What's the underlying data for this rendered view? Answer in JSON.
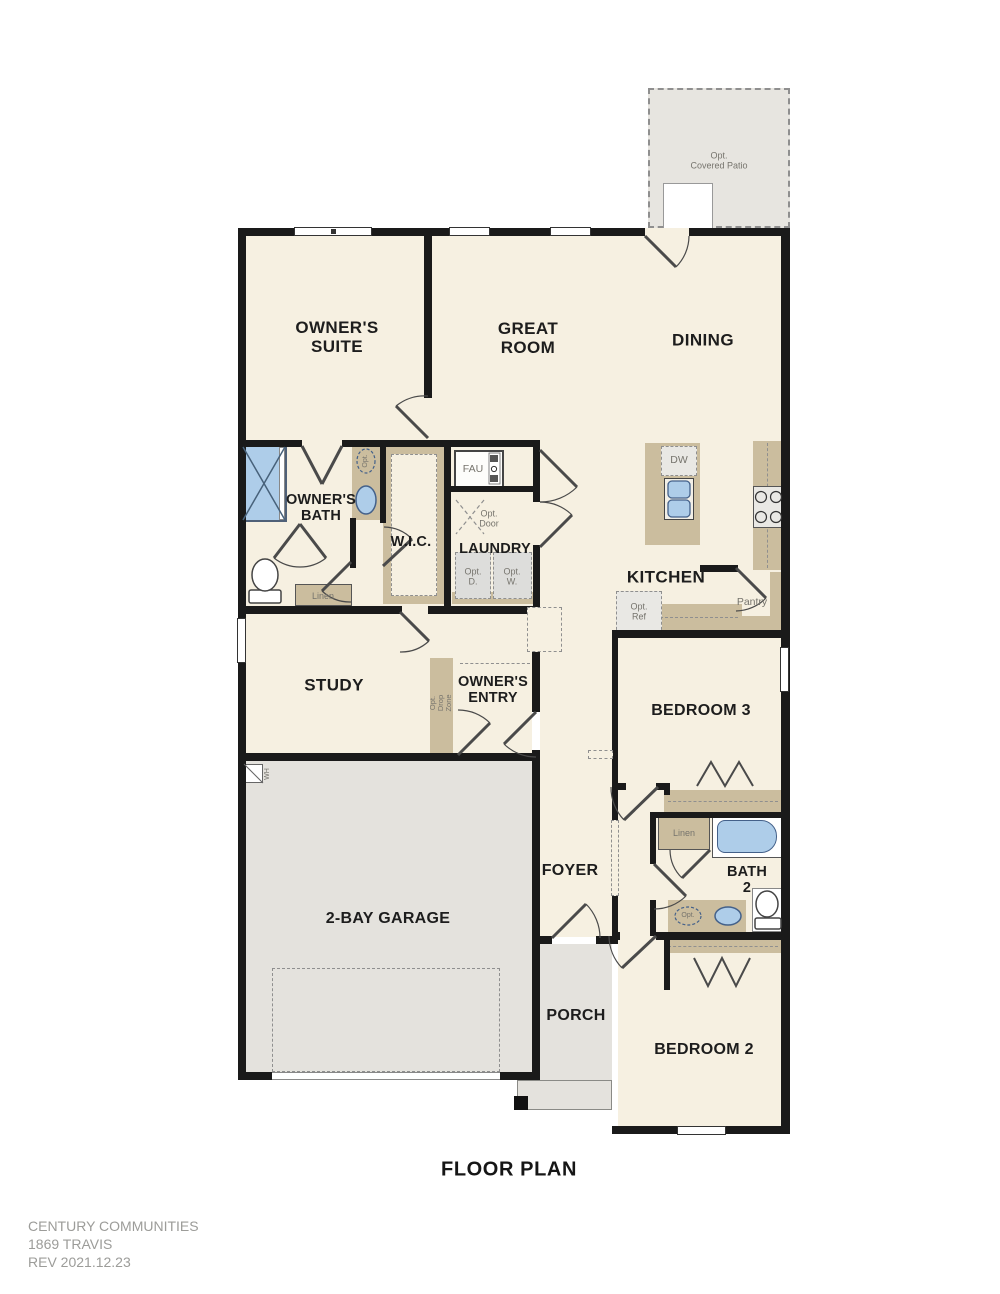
{
  "title": "FLOOR PLAN",
  "footer": {
    "line1": "CENTURY COMMUNITIES",
    "line2": "1869 TRAVIS",
    "line3": "REV  2021.12.23"
  },
  "rooms": {
    "owners_suite": "OWNER'S\nSUITE",
    "great_room": "GREAT\nROOM",
    "dining": "DINING",
    "kitchen": "KITCHEN",
    "owners_bath": "OWNER'S\nBATH",
    "wic": "W.I.C.",
    "laundry": "LAUNDRY",
    "study": "STUDY",
    "owners_entry": "OWNER'S\nENTRY",
    "bedroom3": "BEDROOM 3",
    "bath2": "BATH\n2",
    "bedroom2": "BEDROOM 2",
    "foyer": "FOYER",
    "porch": "PORCH",
    "garage": "2-BAY GARAGE"
  },
  "annotations": {
    "opt_covered_patio": "Opt.\nCovered Patio",
    "fau": "FAU",
    "dw": "DW",
    "opt_door": "Opt.\nDoor",
    "opt_dryer": "Opt.\nD.",
    "opt_washer": "Opt.\nW.",
    "opt_ref": "Opt.\nRef",
    "pantry": "Pantry",
    "linen_owners_bath": "Linen",
    "linen_bath2": "Linen",
    "opt_sink_owners_bath": "Opt.",
    "opt_sink_bath2": "Opt.",
    "opt_drop_zone": "Opt.\nDrop\nZone",
    "water_heater": "WH"
  },
  "colors": {
    "floor_cream": "#f6f0e1",
    "floor_grey": "#e4e2dd",
    "patio_grey": "#e7e5e0",
    "counter_tan": "#cbbd9e",
    "wall": "#1a1a1a",
    "fixture_blue": "#aecde9",
    "fixture_blue_border": "#44618a",
    "appliance_grey": "#e9e8e4",
    "dash_grey": "#8f8f8f",
    "text_dark": "#1d1d1d",
    "text_grey": "#76746d",
    "text_grey_footer": "#9c9c99"
  }
}
